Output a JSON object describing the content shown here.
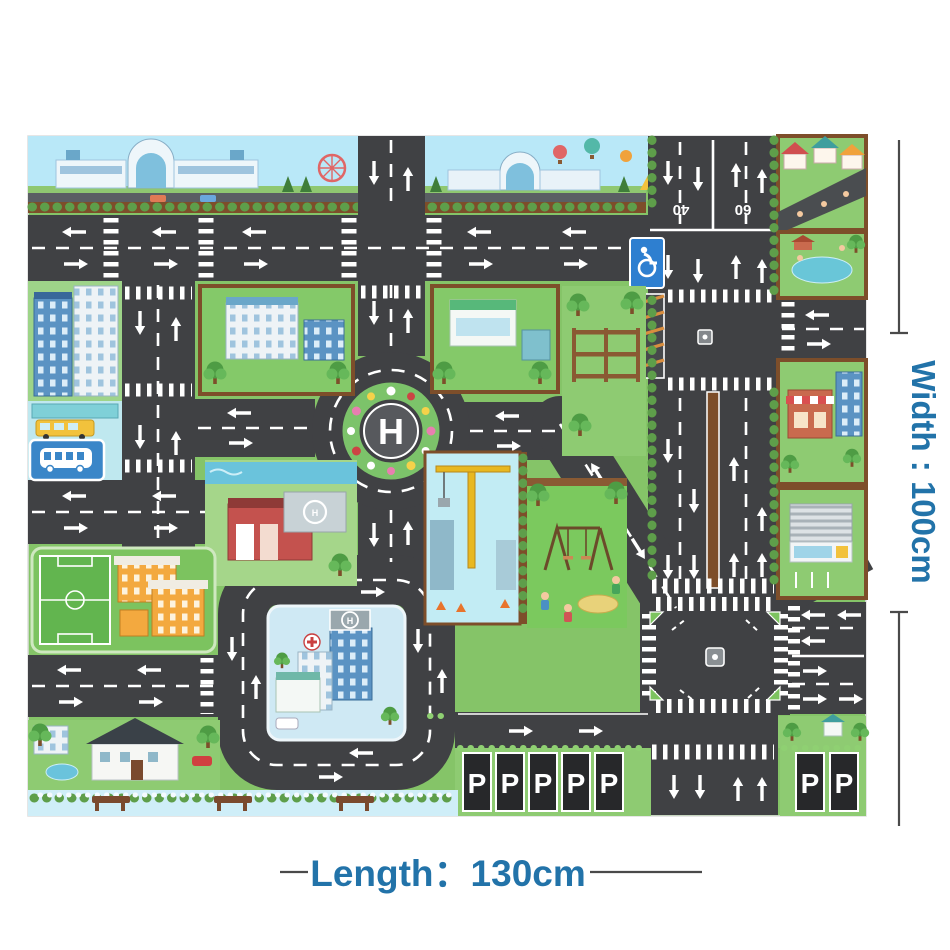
{
  "title": "City traffic road play mat product image",
  "dimensions": {
    "width_label": "Width : 100cm",
    "length_label": "Length：130cm"
  },
  "mat": {
    "roundabout_helipad": "H",
    "hospital_helipad": "H",
    "fire_station_helipad": "H",
    "speed_markings": [
      "40",
      "60"
    ],
    "parking_row_left": [
      "P",
      "P",
      "P",
      "P",
      "P"
    ],
    "parking_row_right": [
      "P",
      "P"
    ]
  },
  "icons": {
    "disabled_parking": "wheelchair",
    "bus_stop": "bus-side",
    "helipad": "circled-H",
    "red_cross": "plus-in-circle",
    "bench": "park-bench",
    "tree": "round-tree"
  },
  "colors": {
    "dimension_text": "#2273a9",
    "dimension_line": "#4a4a4a",
    "road": "#404144",
    "marking": "#ffffff",
    "grass": "#85c468",
    "sky": "#b9e8f8",
    "water": "#6ac3dc",
    "sign_blue": "#2e7fd0",
    "parking_stall": "#27282a",
    "hatch_orange": "#d98e3f"
  }
}
